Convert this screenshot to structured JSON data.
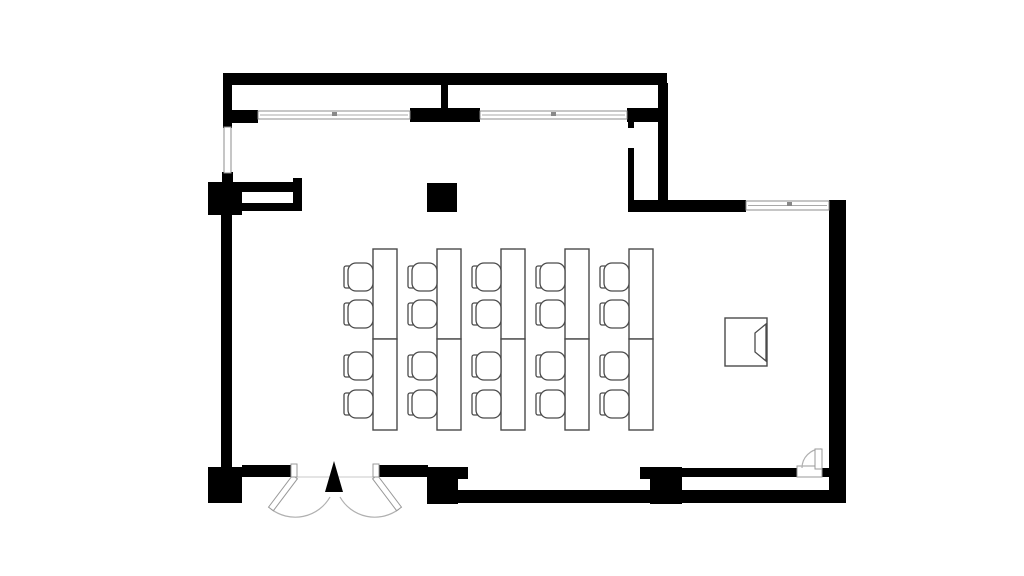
{
  "meta": {
    "title": "seminar-room-floor-plan",
    "drawing_type": "architectural floor plan, black and white",
    "canvas": {
      "width": 1024,
      "height": 576
    }
  },
  "palette": {
    "background": "#ffffff",
    "wall": "#000000",
    "furniture_stroke": "#4a4a4a",
    "window_stroke": "#8c8c8c",
    "window_tick": "#888888",
    "door_leaf_stroke": "#999999",
    "door_arc_stroke": "#b0b0b0",
    "opening_line": "#c8c8c8",
    "entrance_arrow_fill": "#000000"
  },
  "counts": {
    "desk_columns": 5,
    "desk_tables": 10,
    "chairs": 20,
    "windows": 4,
    "entrance_double_doors": 1,
    "single_doors": 1,
    "freestanding_columns": 1,
    "lecterns": 1,
    "sideboards": 1
  },
  "plan": {
    "walls": [
      {
        "r": [
          223,
          73,
          444,
          12
        ],
        "n": "wall-top"
      },
      {
        "r": [
          223,
          85,
          9,
          43
        ],
        "n": "wall-left-upper"
      },
      {
        "r": [
          231,
          110,
          27,
          13
        ],
        "n": "window-sill-stub-left"
      },
      {
        "r": [
          222,
          172,
          11,
          11
        ],
        "n": "window-end-tick-left"
      },
      {
        "r": [
          208,
          182,
          34,
          33
        ],
        "n": "pier-sideboard"
      },
      {
        "r": [
          242,
          182,
          60,
          10
        ],
        "n": "sideboard-top"
      },
      {
        "r": [
          293,
          178,
          9,
          33
        ],
        "n": "sideboard-right"
      },
      {
        "r": [
          242,
          203,
          60,
          8
        ],
        "n": "sideboard-bottom"
      },
      {
        "r": [
          221,
          212,
          11,
          255
        ],
        "n": "wall-left-lower"
      },
      {
        "r": [
          208,
          467,
          34,
          36
        ],
        "n": "pier-bottom-left"
      },
      {
        "r": [
          242,
          465,
          50,
          12
        ],
        "n": "wall-bottom-door-left"
      },
      {
        "r": [
          378,
          465,
          50,
          12
        ],
        "n": "wall-bottom-door-right"
      },
      {
        "r": [
          427,
          467,
          31,
          37
        ],
        "n": "pier-bottom-1"
      },
      {
        "r": [
          458,
          467,
          10,
          12
        ],
        "n": "jamb-hook-1"
      },
      {
        "r": [
          640,
          467,
          10,
          12
        ],
        "n": "jamb-hook-2"
      },
      {
        "r": [
          650,
          467,
          32,
          37
        ],
        "n": "pier-bottom-2"
      },
      {
        "r": [
          458,
          490,
          388,
          13
        ],
        "n": "wall-bottom-outer"
      },
      {
        "r": [
          682,
          468,
          115,
          9
        ],
        "n": "wall-bottom-inner"
      },
      {
        "r": [
          822,
          468,
          8,
          9
        ],
        "n": "wall-bottom-inner-right"
      },
      {
        "r": [
          829,
          200,
          17,
          303
        ],
        "n": "wall-right"
      },
      {
        "r": [
          628,
          200,
          118,
          12
        ],
        "n": "wall-top-right-section"
      },
      {
        "r": [
          441,
          75,
          7,
          35
        ],
        "n": "window-mid-pier"
      },
      {
        "r": [
          410,
          108,
          70,
          14
        ],
        "n": "window-sill-stub-mid"
      },
      {
        "r": [
          627,
          108,
          32,
          14
        ],
        "n": "window-sill-stub-right"
      },
      {
        "r": [
          658,
          83,
          10,
          122
        ],
        "n": "wall-cavity-outer-leaf"
      },
      {
        "r": [
          628,
          119,
          6,
          9
        ],
        "n": "wall-cavity-inner-tick"
      },
      {
        "r": [
          628,
          148,
          6,
          54
        ],
        "n": "wall-cavity-inner-leaf"
      },
      {
        "r": [
          427,
          183,
          30,
          29
        ],
        "n": "structural-column"
      }
    ],
    "windows": [
      {
        "x": 258,
        "y": 111,
        "w": 152,
        "h": 8,
        "tick": 332,
        "vertical": false,
        "n": "window-top-1"
      },
      {
        "x": 480,
        "y": 111,
        "w": 147,
        "h": 8,
        "tick": 551,
        "vertical": false,
        "n": "window-top-2"
      },
      {
        "x": 746,
        "y": 201,
        "w": 83,
        "h": 9,
        "tick": 787,
        "vertical": false,
        "n": "window-right-section"
      },
      {
        "x": 224,
        "y": 127,
        "w": 7,
        "h": 46,
        "tick": null,
        "vertical": true,
        "n": "window-left"
      }
    ],
    "desks": {
      "columns": [
        373,
        437,
        501,
        565,
        629
      ],
      "table_w": 24,
      "top": 249,
      "mid": 339,
      "bottom": 430,
      "chair_rows": [
        263,
        300,
        352,
        390
      ],
      "chair": {
        "seat_w": 25,
        "seat_h": 28,
        "seat_r": 8,
        "back_w": 7,
        "back_h": 22
      }
    },
    "entrance": {
      "opening_line": {
        "x1": 297,
        "y1": 477,
        "x2": 373,
        "y2": 477
      },
      "jambs": [
        [
          291,
          464,
          6,
          13
        ],
        [
          373,
          464,
          6,
          13
        ]
      ],
      "leaves": [
        {
          "hinge": [
            295,
            477
          ],
          "angle": 127,
          "len": 40,
          "w": 6
        },
        {
          "hinge": [
            375,
            477
          ],
          "angle": 53,
          "len": 40,
          "w": 6
        }
      ],
      "arcs": [
        "M 271 509 A 40 40 0 0 0 330 497",
        "M 399 509 A 40 40 0 0 1 340 497"
      ],
      "arrow": [
        [
          334,
          461
        ],
        [
          325,
          492
        ],
        [
          343,
          492
        ]
      ]
    },
    "side_door": {
      "threshold": [
        797,
        466,
        25,
        11
      ],
      "leaf": [
        815,
        449,
        7,
        20
      ],
      "arc": "M 821 449 A 19 19 0 0 0 802 468"
    },
    "lectern": {
      "box": [
        725,
        318,
        42,
        48
      ],
      "poly": [
        [
          766,
          324
        ],
        [
          755,
          333
        ],
        [
          755,
          352
        ],
        [
          766,
          361
        ]
      ]
    }
  }
}
